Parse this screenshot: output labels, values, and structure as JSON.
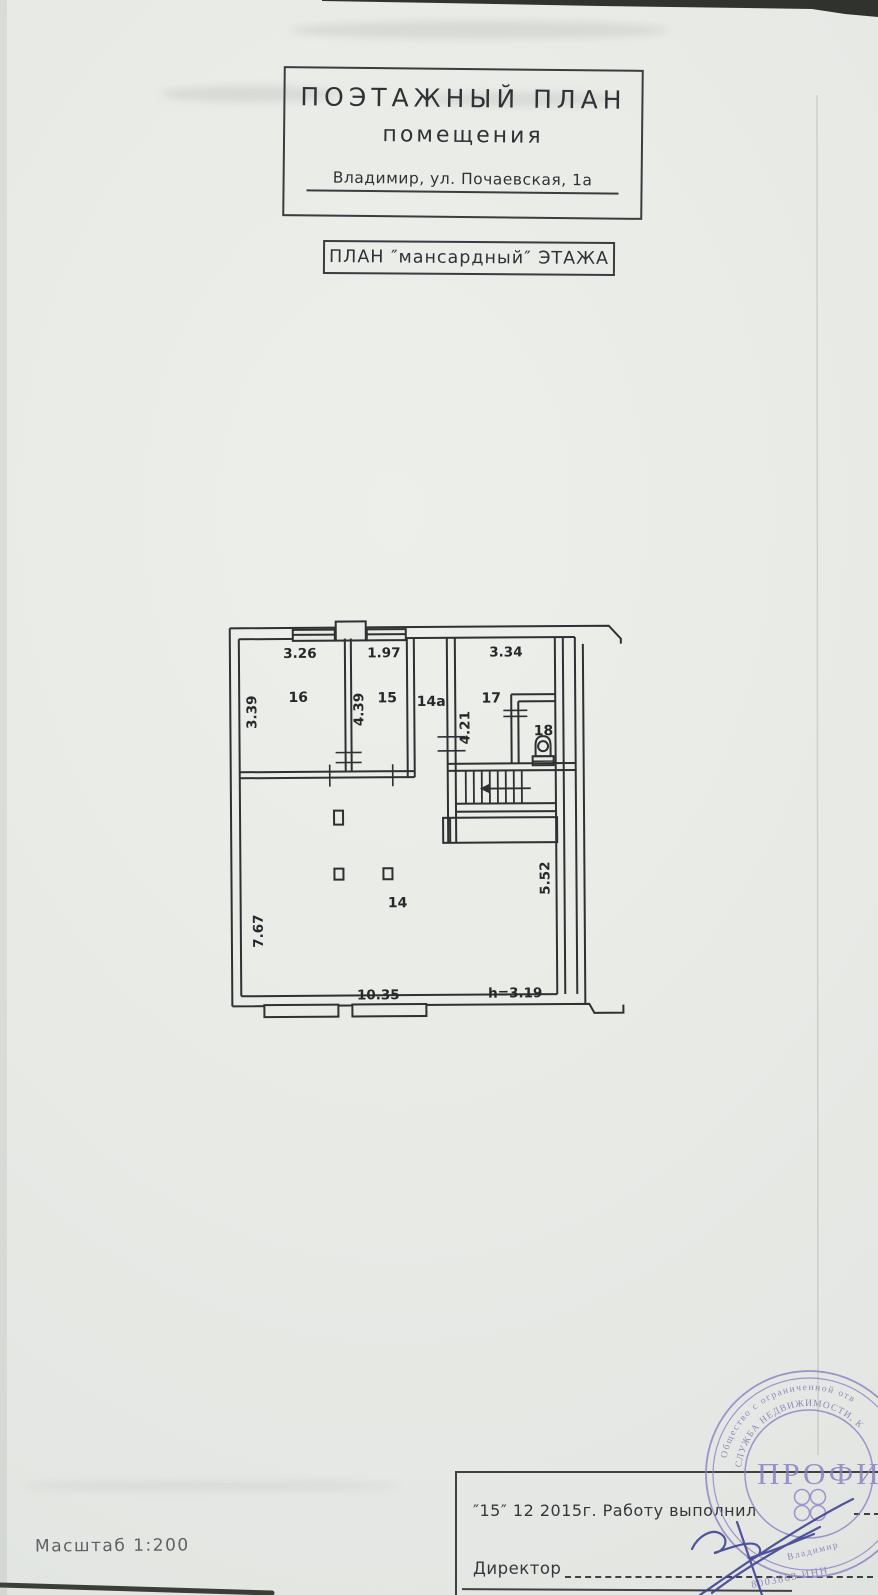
{
  "colors": {
    "paper": "#e8eae6",
    "ink": "#2e3032",
    "stamp_purple": "#8b80c3",
    "signature_blue": "#3e3f92"
  },
  "document": {
    "title_line1": "ПОЭТАЖНЫЙ ПЛАН",
    "title_line2": "помещения",
    "address": "Владимир, ул. Почаевская, 1а",
    "floor_label": "ПЛАН ″мансардный″ ЭТАЖА",
    "scale_label": "Масштаб 1:200"
  },
  "plan": {
    "rooms": {
      "r16": {
        "number": "16",
        "width": "3.26",
        "depth": "3.39"
      },
      "r15": {
        "number": "15",
        "width": "1.97",
        "depth": "4.39"
      },
      "r14a": {
        "number": "14а"
      },
      "r17": {
        "number": "17",
        "width": "3.34",
        "depth": "4.21"
      },
      "r18": {
        "number": "18"
      },
      "r14": {
        "number": "14",
        "width": "10.35",
        "depth": "7.67",
        "right_depth": "5.52",
        "ceiling_height": "h=3.19"
      }
    }
  },
  "footer": {
    "date_work_line": "″15″   12 2015г.   Работу выполнил",
    "director_label": "Директор",
    "stamp": {
      "outer_ring_text": "Общество с ограниченной отв",
      "inner_ring_text": "СЛУЖБА НЕДВИЖИМОСТИ, К",
      "company_name": "ПРОФИ",
      "city_text": "Владимир",
      "number_text": "8003863 ИНН"
    }
  }
}
